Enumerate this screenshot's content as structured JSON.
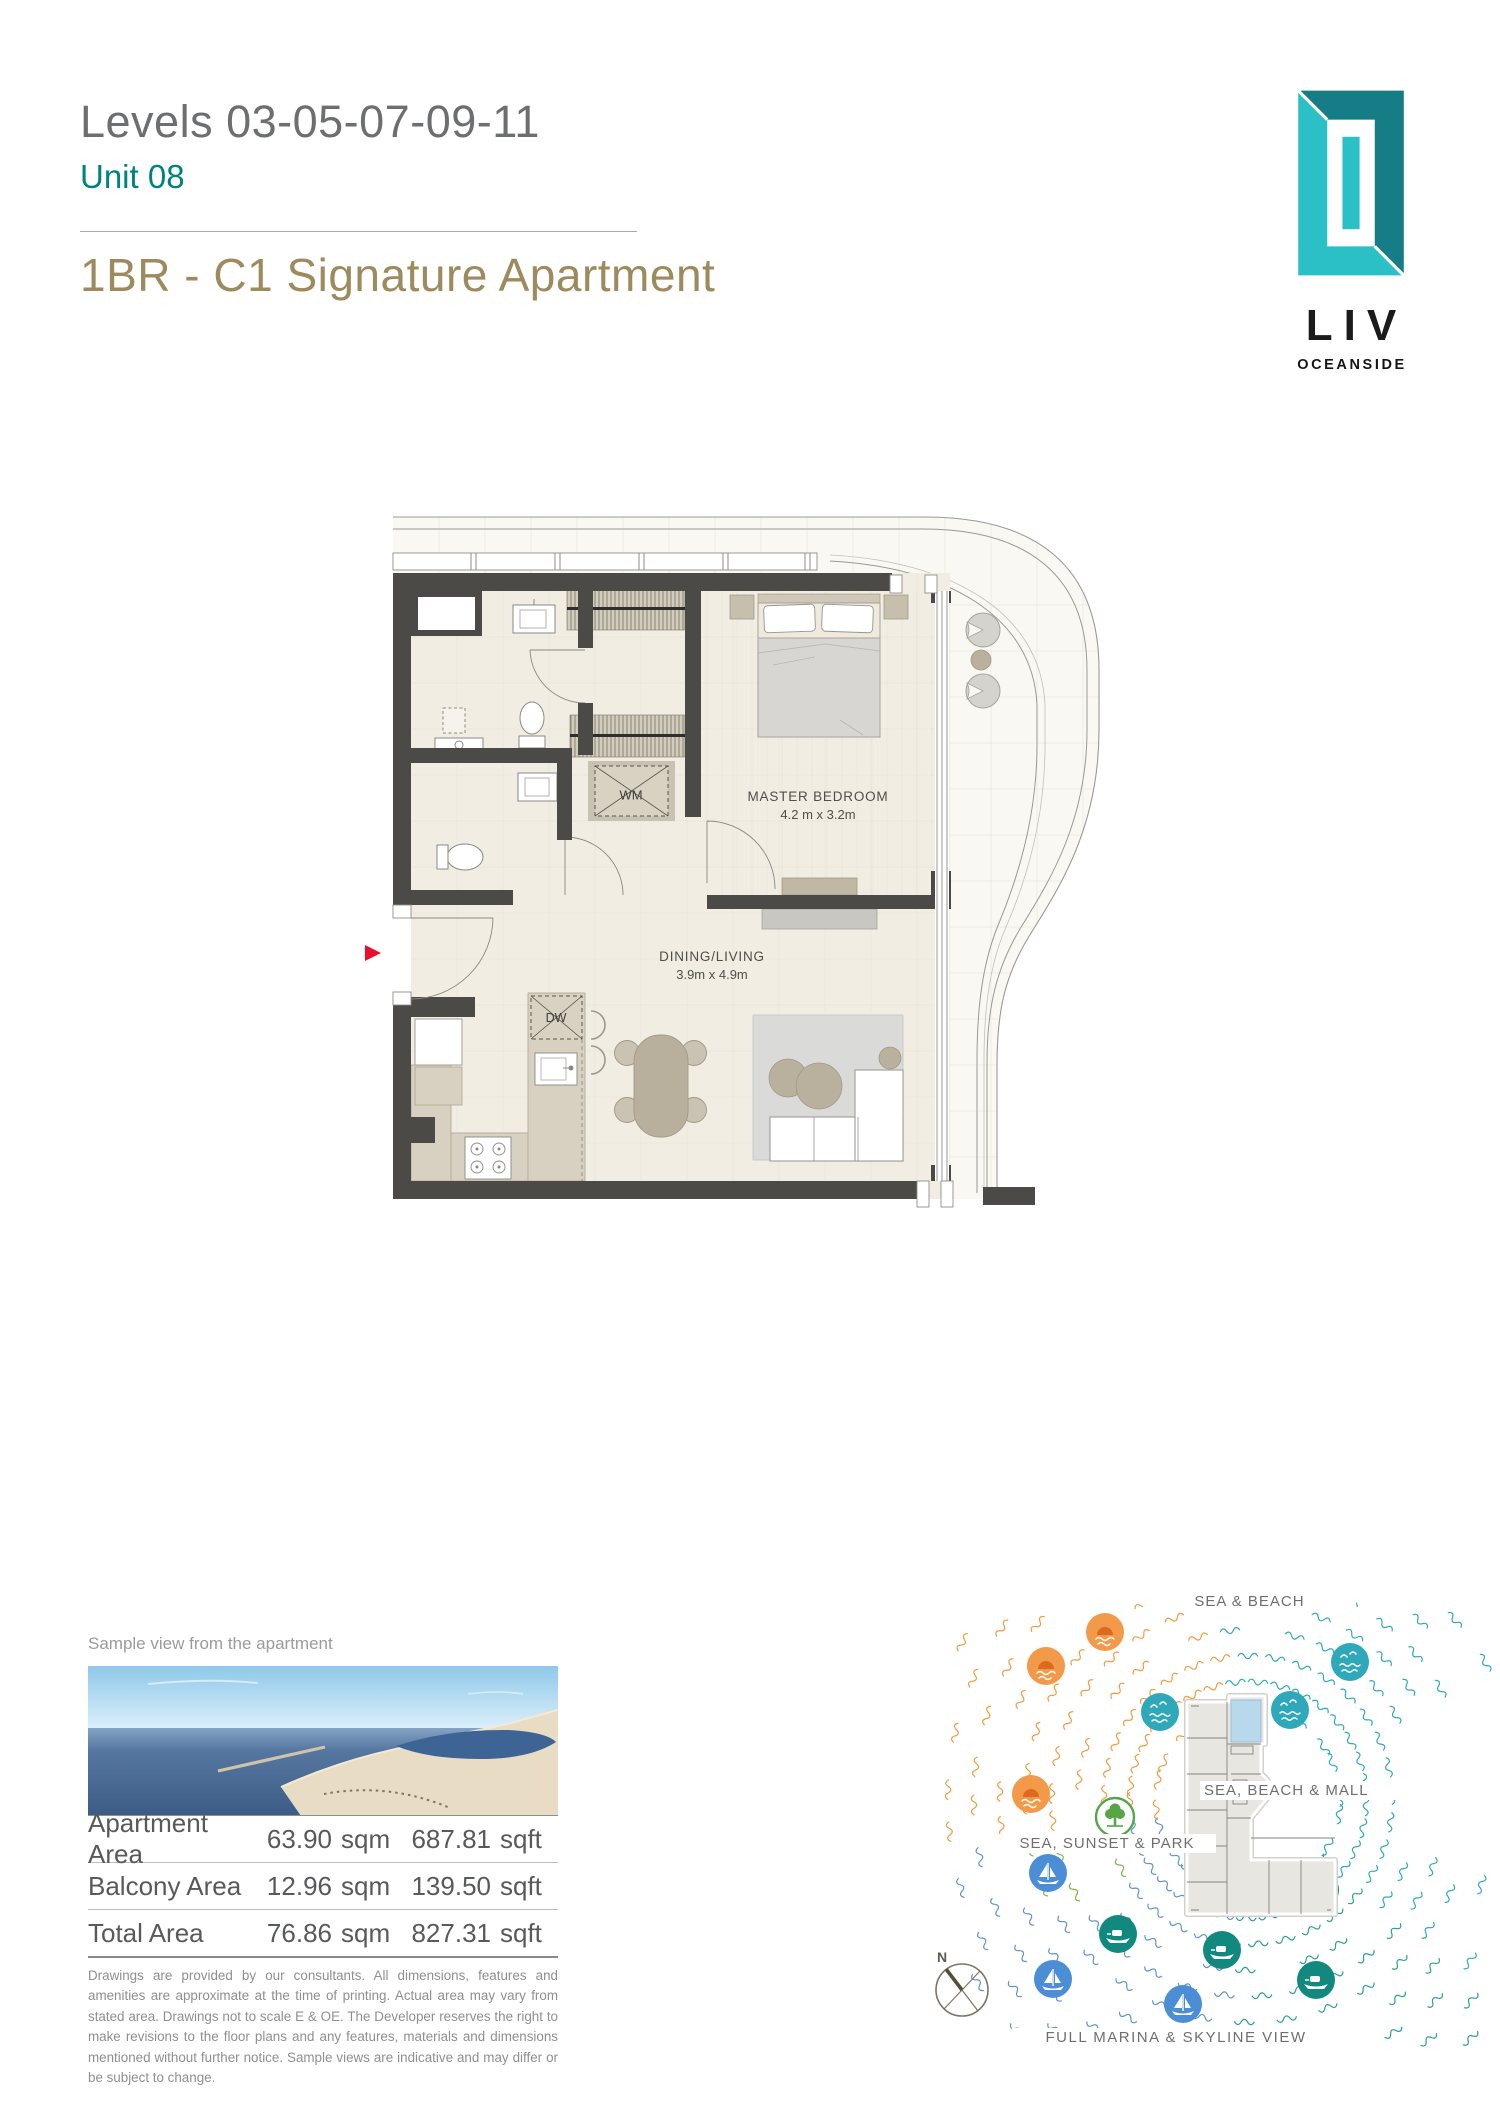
{
  "header": {
    "levels": "Levels 03-05-07-09-11",
    "unit": "Unit 08",
    "title": "1BR - C1 Signature Apartment"
  },
  "logo": {
    "name": "LIV",
    "tagline": "OCEANSIDE"
  },
  "floorplan": {
    "master_bedroom": "MASTER BEDROOM",
    "master_bedroom_dims": "4.2 m x 3.2m",
    "dining_living": "DINING/LIVING",
    "dining_living_dims": "3.9m x 4.9m",
    "washing_machine": "WM",
    "dishwasher": "DW"
  },
  "view_section": {
    "caption": "Sample view from the apartment"
  },
  "areas": {
    "units": {
      "sqm": "sqm",
      "sqft": "sqft"
    },
    "rows": [
      {
        "label": "Apartment Area",
        "sqm": "63.90",
        "sqft": "687.81"
      },
      {
        "label": "Balcony Area",
        "sqm": "12.96",
        "sqft": "139.50"
      },
      {
        "label": "Total Area",
        "sqm": "76.86",
        "sqft": "827.31"
      }
    ],
    "disclaimer": "Drawings are provided by our consultants. All dimensions, features and amenities are approximate at the time of printing. Actual area may vary from stated area.  Drawings not to scale E & OE.  The Developer reserves the right to make revisions to the floor plans and any features, materials and dimensions mentioned without further notice.  Sample views are indicative and may differ or be subject to change."
  },
  "site_diagram": {
    "label_top": "SEA & BEACH",
    "label_right": "SEA, BEACH & MALL",
    "label_left": "SEA, SUNSET & PARK",
    "label_bottom": "FULL MARINA & SKYLINE VIEW",
    "compass": "N"
  },
  "colors": {
    "teal": "#00837E",
    "gold": "#9D8A5D",
    "wall": "#4B4A47",
    "arrow_red": "#E8112D",
    "wave_teal": "#2FA9BA",
    "wave_orange": "#F09A3E",
    "wave_blue": "#5E93CE",
    "wave_green": "#7FB24A",
    "icon_yacht": "#12897F",
    "icon_sailboat": "#4C8ED6",
    "icon_sunset": "#F2994A",
    "icon_tree": "#56A546",
    "unit_highlight": "#B7D9EB",
    "logo_teal_light": "#2BBFC6",
    "logo_teal_dark": "#167C85"
  }
}
